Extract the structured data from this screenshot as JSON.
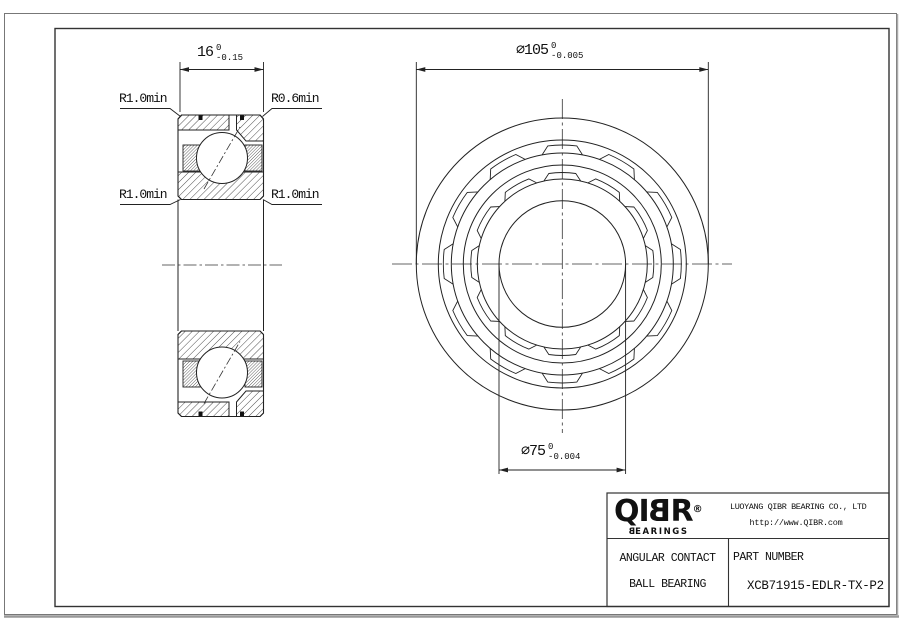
{
  "drawing": {
    "dim_width": {
      "value": "16",
      "tol_upper": "0",
      "tol_lower": "-0.15"
    },
    "dim_od": {
      "value": "⌀105",
      "tol_upper": "0",
      "tol_lower": "-0.005"
    },
    "dim_bore": {
      "value": "⌀75",
      "tol_upper": "0",
      "tol_lower": "-0.004"
    },
    "callouts": {
      "top_left": "R1.0min",
      "top_right": "R0.6min",
      "mid_left": "R1.0min",
      "mid_right": "R1.0min"
    }
  },
  "title_block": {
    "logo": {
      "prefix": "QI",
      "mirrored_letter": "B",
      "suffix": "R",
      "registered": "®",
      "sub_first": "B",
      "sub_rest": "EARINGS"
    },
    "company": "LUOYANG QIBR BEARING CO., LTD",
    "website": "http://www.QIBR.com",
    "product_line1": "ANGULAR CONTACT",
    "product_line2": "BALL BEARING",
    "part_label": "PART NUMBER",
    "part_number": "XCB71915-EDLR-TX-P2"
  },
  "colors": {
    "line": "#222222",
    "frame": "#333333",
    "shadow": "#999999",
    "text": "#111111"
  }
}
